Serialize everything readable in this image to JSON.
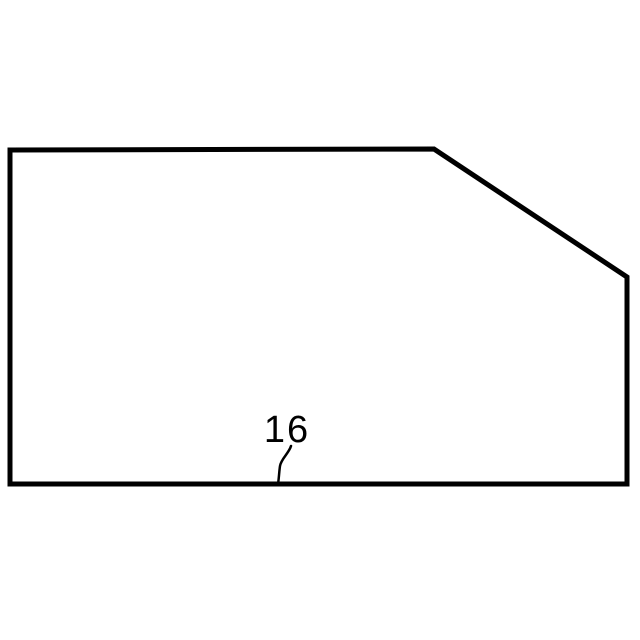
{
  "figure": {
    "label": "16",
    "outline_points": "10,150 434,149 627,277 627,484 10,484",
    "leader_path": "M 291,446 C 289,453 281,459 280,466 C 279,473 279,478 278,484",
    "stroke_color": "#000000",
    "label_color": "#000000",
    "background_color": "#ffffff"
  }
}
